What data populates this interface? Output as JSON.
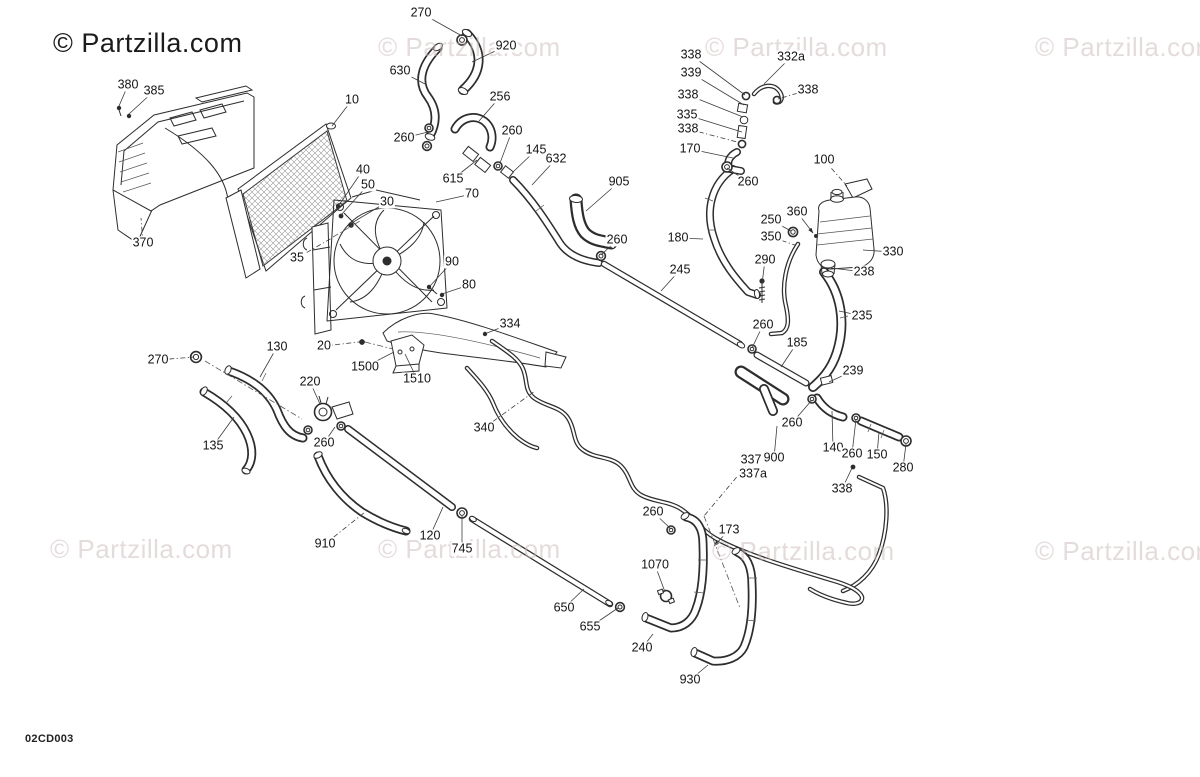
{
  "page": {
    "diagram_code": "02CD003"
  },
  "branding": {
    "logo_text": "© Partzilla.com",
    "watermark_text": "© Partzilla.com",
    "logo_color": "#1b1b1b",
    "watermark_color": "#cbb9b9"
  },
  "watermarks": [
    {
      "x": 53,
      "y": 30,
      "variant": "logo"
    },
    {
      "x": 378,
      "y": 34,
      "variant": "faint"
    },
    {
      "x": 705,
      "y": 34,
      "variant": "faint"
    },
    {
      "x": 1035,
      "y": 34,
      "variant": "faint"
    },
    {
      "x": 50,
      "y": 536,
      "variant": "faint"
    },
    {
      "x": 378,
      "y": 536,
      "variant": "faint"
    },
    {
      "x": 712,
      "y": 538,
      "variant": "faint"
    },
    {
      "x": 1035,
      "y": 538,
      "variant": "faint"
    }
  ],
  "callouts": [
    {
      "label": "270",
      "x": 421,
      "y": 13,
      "tx": 462,
      "ty": 36
    },
    {
      "label": "920",
      "x": 506,
      "y": 46,
      "tx": 472,
      "ty": 62
    },
    {
      "label": "630",
      "x": 400,
      "y": 71,
      "tx": 425,
      "ty": 84
    },
    {
      "label": "380",
      "x": 128,
      "y": 85,
      "tx": 119,
      "ty": 106
    },
    {
      "label": "385",
      "x": 154,
      "y": 91,
      "tx": 129,
      "ty": 114
    },
    {
      "label": "10",
      "x": 352,
      "y": 100,
      "tx": 332,
      "ty": 126
    },
    {
      "label": "256",
      "x": 500,
      "y": 97,
      "tx": 479,
      "ty": 121
    },
    {
      "label": "338",
      "x": 691,
      "y": 55,
      "tx": 745,
      "ty": 95
    },
    {
      "label": "332a",
      "x": 791,
      "y": 57,
      "tx": 764,
      "ty": 84
    },
    {
      "label": "339",
      "x": 691,
      "y": 73,
      "tx": 744,
      "ty": 105
    },
    {
      "label": "338",
      "x": 808,
      "y": 90,
      "tx": 778,
      "ty": 99,
      "dash": true
    },
    {
      "label": "338",
      "x": 688,
      "y": 95,
      "tx": 743,
      "ty": 117
    },
    {
      "label": "335",
      "x": 687,
      "y": 115,
      "tx": 742,
      "ty": 132
    },
    {
      "label": "338",
      "x": 688,
      "y": 129,
      "tx": 741,
      "ty": 143,
      "dash": true
    },
    {
      "label": "170",
      "x": 690,
      "y": 149,
      "tx": 733,
      "ty": 158
    },
    {
      "label": "100",
      "x": 824,
      "y": 160,
      "tx": 847,
      "ty": 186,
      "dash": true
    },
    {
      "label": "260",
      "x": 748,
      "y": 182,
      "tx": 727,
      "ty": 168
    },
    {
      "label": "260",
      "x": 404,
      "y": 138,
      "tx": 428,
      "ty": 132
    },
    {
      "label": "260",
      "x": 512,
      "y": 131,
      "tx": 500,
      "ty": 163
    },
    {
      "label": "145",
      "x": 536,
      "y": 150,
      "tx": 513,
      "ty": 172
    },
    {
      "label": "632",
      "x": 556,
      "y": 159,
      "tx": 532,
      "ty": 185
    },
    {
      "label": "615",
      "x": 453,
      "y": 179,
      "tx": 477,
      "ty": 160
    },
    {
      "label": "905",
      "x": 619,
      "y": 182,
      "tx": 586,
      "ty": 211
    },
    {
      "label": "40",
      "x": 363,
      "y": 170,
      "tx": 339,
      "ty": 205
    },
    {
      "label": "50",
      "x": 368,
      "y": 185,
      "tx": 341,
      "ty": 215
    },
    {
      "label": "30",
      "x": 387,
      "y": 202,
      "tx": 350,
      "ty": 224
    },
    {
      "label": "70",
      "x": 472,
      "y": 194,
      "tx": 436,
      "ty": 202
    },
    {
      "label": "90",
      "x": 452,
      "y": 262,
      "tx": 430,
      "ty": 286
    },
    {
      "label": "80",
      "x": 469,
      "y": 285,
      "tx": 442,
      "ty": 294
    },
    {
      "label": "260",
      "x": 617,
      "y": 240,
      "tx": 601,
      "ty": 255
    },
    {
      "label": "370",
      "x": 143,
      "y": 243,
      "tx": 141,
      "ty": 218,
      "dash": true
    },
    {
      "label": "35",
      "x": 297,
      "y": 258,
      "tx": 332,
      "ty": 238,
      "dash": true
    },
    {
      "label": "245",
      "x": 680,
      "y": 270,
      "tx": 661,
      "ty": 291
    },
    {
      "label": "180",
      "x": 678,
      "y": 238,
      "tx": 703,
      "ty": 239
    },
    {
      "label": "360",
      "x": 797,
      "y": 212,
      "tx": 813,
      "ty": 233,
      "arrow": true
    },
    {
      "label": "250",
      "x": 771,
      "y": 220,
      "tx": 791,
      "ty": 231
    },
    {
      "label": "350",
      "x": 771,
      "y": 237,
      "tx": 795,
      "ty": 245,
      "dash": true
    },
    {
      "label": "330",
      "x": 893,
      "y": 252,
      "tx": 863,
      "ty": 250
    },
    {
      "label": "290",
      "x": 765,
      "y": 260,
      "tx": 762,
      "ty": 284
    },
    {
      "label": "238",
      "x": 864,
      "y": 272,
      "tx": 831,
      "ty": 268
    },
    {
      "label": "235",
      "x": 862,
      "y": 316,
      "tx": 839,
      "ty": 311
    },
    {
      "label": "260",
      "x": 763,
      "y": 325,
      "tx": 752,
      "ty": 348
    },
    {
      "label": "185",
      "x": 797,
      "y": 343,
      "tx": 781,
      "ty": 367
    },
    {
      "label": "239",
      "x": 853,
      "y": 371,
      "tx": 829,
      "ty": 382
    },
    {
      "label": "334",
      "x": 510,
      "y": 324,
      "tx": 487,
      "ty": 333
    },
    {
      "label": "270",
      "x": 158,
      "y": 360,
      "tx": 194,
      "ty": 357,
      "dash": true
    },
    {
      "label": "130",
      "x": 277,
      "y": 347,
      "tx": 260,
      "ty": 377
    },
    {
      "label": "20",
      "x": 324,
      "y": 346,
      "tx": 359,
      "ty": 342,
      "dash": true
    },
    {
      "label": "1500",
      "x": 365,
      "y": 367,
      "tx": 394,
      "ty": 352
    },
    {
      "label": "1510",
      "x": 417,
      "y": 379,
      "tx": 405,
      "ty": 354
    },
    {
      "label": "220",
      "x": 310,
      "y": 382,
      "tx": 320,
      "ty": 404
    },
    {
      "label": "340",
      "x": 484,
      "y": 428,
      "tx": 535,
      "ty": 391,
      "dash": true
    },
    {
      "label": "135",
      "x": 213,
      "y": 446,
      "tx": 234,
      "ty": 417
    },
    {
      "label": "260",
      "x": 324,
      "y": 443,
      "tx": 335,
      "ty": 427
    },
    {
      "label": "337",
      "x": 751,
      "y": 460,
      "tx": 704,
      "ty": 516,
      "dash": true
    },
    {
      "label": "337a",
      "x": 753,
      "y": 474,
      "tx": null,
      "ty": null
    },
    {
      "label": "900",
      "x": 774,
      "y": 458,
      "tx": 777,
      "ty": 426
    },
    {
      "label": "260",
      "x": 792,
      "y": 423,
      "tx": 812,
      "ty": 400
    },
    {
      "label": "140",
      "x": 833,
      "y": 448,
      "tx": 832,
      "ty": 411
    },
    {
      "label": "260",
      "x": 852,
      "y": 454,
      "tx": 856,
      "ty": 419
    },
    {
      "label": "150",
      "x": 877,
      "y": 455,
      "tx": 879,
      "ty": 432
    },
    {
      "label": "280",
      "x": 903,
      "y": 468,
      "tx": 906,
      "ty": 444
    },
    {
      "label": "338",
      "x": 842,
      "y": 489,
      "tx": 852,
      "ty": 468
    },
    {
      "label": "910",
      "x": 325,
      "y": 544,
      "tx": 365,
      "ty": 512,
      "dash": true
    },
    {
      "label": "120",
      "x": 430,
      "y": 536,
      "tx": 443,
      "ty": 507
    },
    {
      "label": "745",
      "x": 462,
      "y": 549,
      "tx": 462,
      "ty": 516
    },
    {
      "label": "260",
      "x": 653,
      "y": 512,
      "tx": 671,
      "ty": 529
    },
    {
      "label": "173",
      "x": 729,
      "y": 530,
      "tx": 714,
      "ty": 546,
      "arrow": true
    },
    {
      "label": "1070",
      "x": 655,
      "y": 565,
      "tx": 665,
      "ty": 592
    },
    {
      "label": "650",
      "x": 564,
      "y": 608,
      "tx": 584,
      "ty": 589
    },
    {
      "label": "655",
      "x": 590,
      "y": 627,
      "tx": 618,
      "ty": 608
    },
    {
      "label": "240",
      "x": 642,
      "y": 648,
      "tx": 653,
      "ty": 634
    },
    {
      "label": "930",
      "x": 690,
      "y": 680,
      "tx": 708,
      "ty": 665
    }
  ]
}
